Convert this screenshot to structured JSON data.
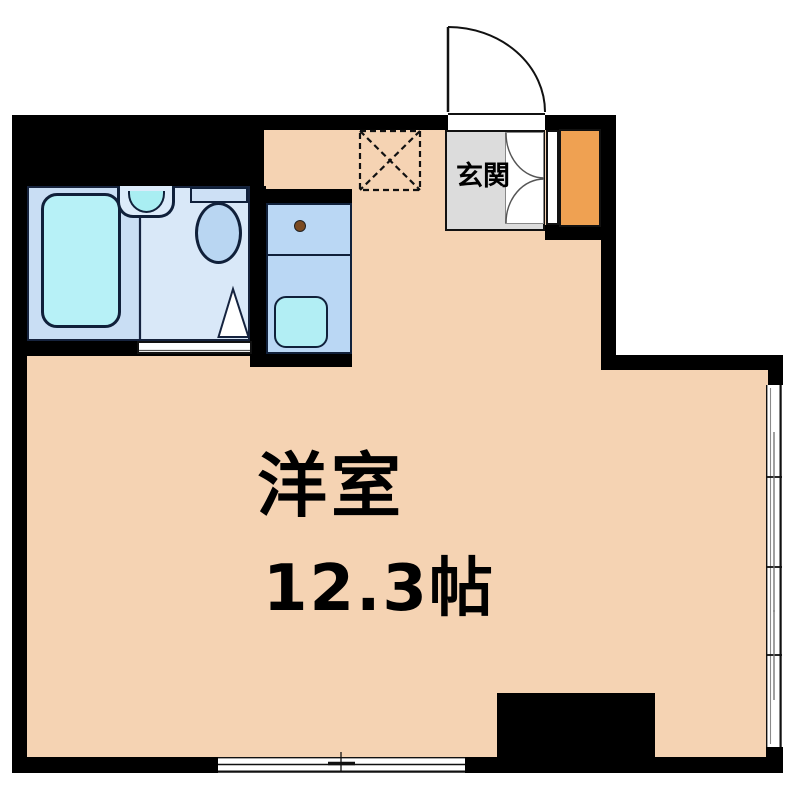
{
  "labels": {
    "entrance": "玄関",
    "main_room": "洋室",
    "main_room_size": "12.3帖"
  },
  "fixtures": {
    "bathtub": "bathtub",
    "washbasin": "washbasin",
    "toilet": "toilet",
    "bathroom_door": "bathroom-door-swing",
    "kitchen_counter": "kitchen-counter",
    "kitchen_sink": "kitchen-sink",
    "faucet": "faucet",
    "washer_space": "washing-machine-space",
    "entrance_door": "entrance-door-swing",
    "closet_doors": "double-door-swing",
    "shoe_cabinet": "shoe-cabinet",
    "window_right": "sliding-window",
    "window_bottom": "sliding-window",
    "pillar": "structural-pillar"
  },
  "colors": {
    "floor": "#f5d3b3",
    "wall": "#000000",
    "bathroom_bg": "#c9def4",
    "washroom_bg": "#d9e8f8",
    "bathtub": "#b7f1f7",
    "fixture_blue": "#bad7f4",
    "sink_cyan": "#b2eef4",
    "basin_cyan": "#a9eef2",
    "genkan_gray": "#dcdcdc",
    "shoe_cabinet_orange": "#efa152",
    "faucet_brown": "#7b4a21",
    "outline_navy": "#10203a"
  }
}
